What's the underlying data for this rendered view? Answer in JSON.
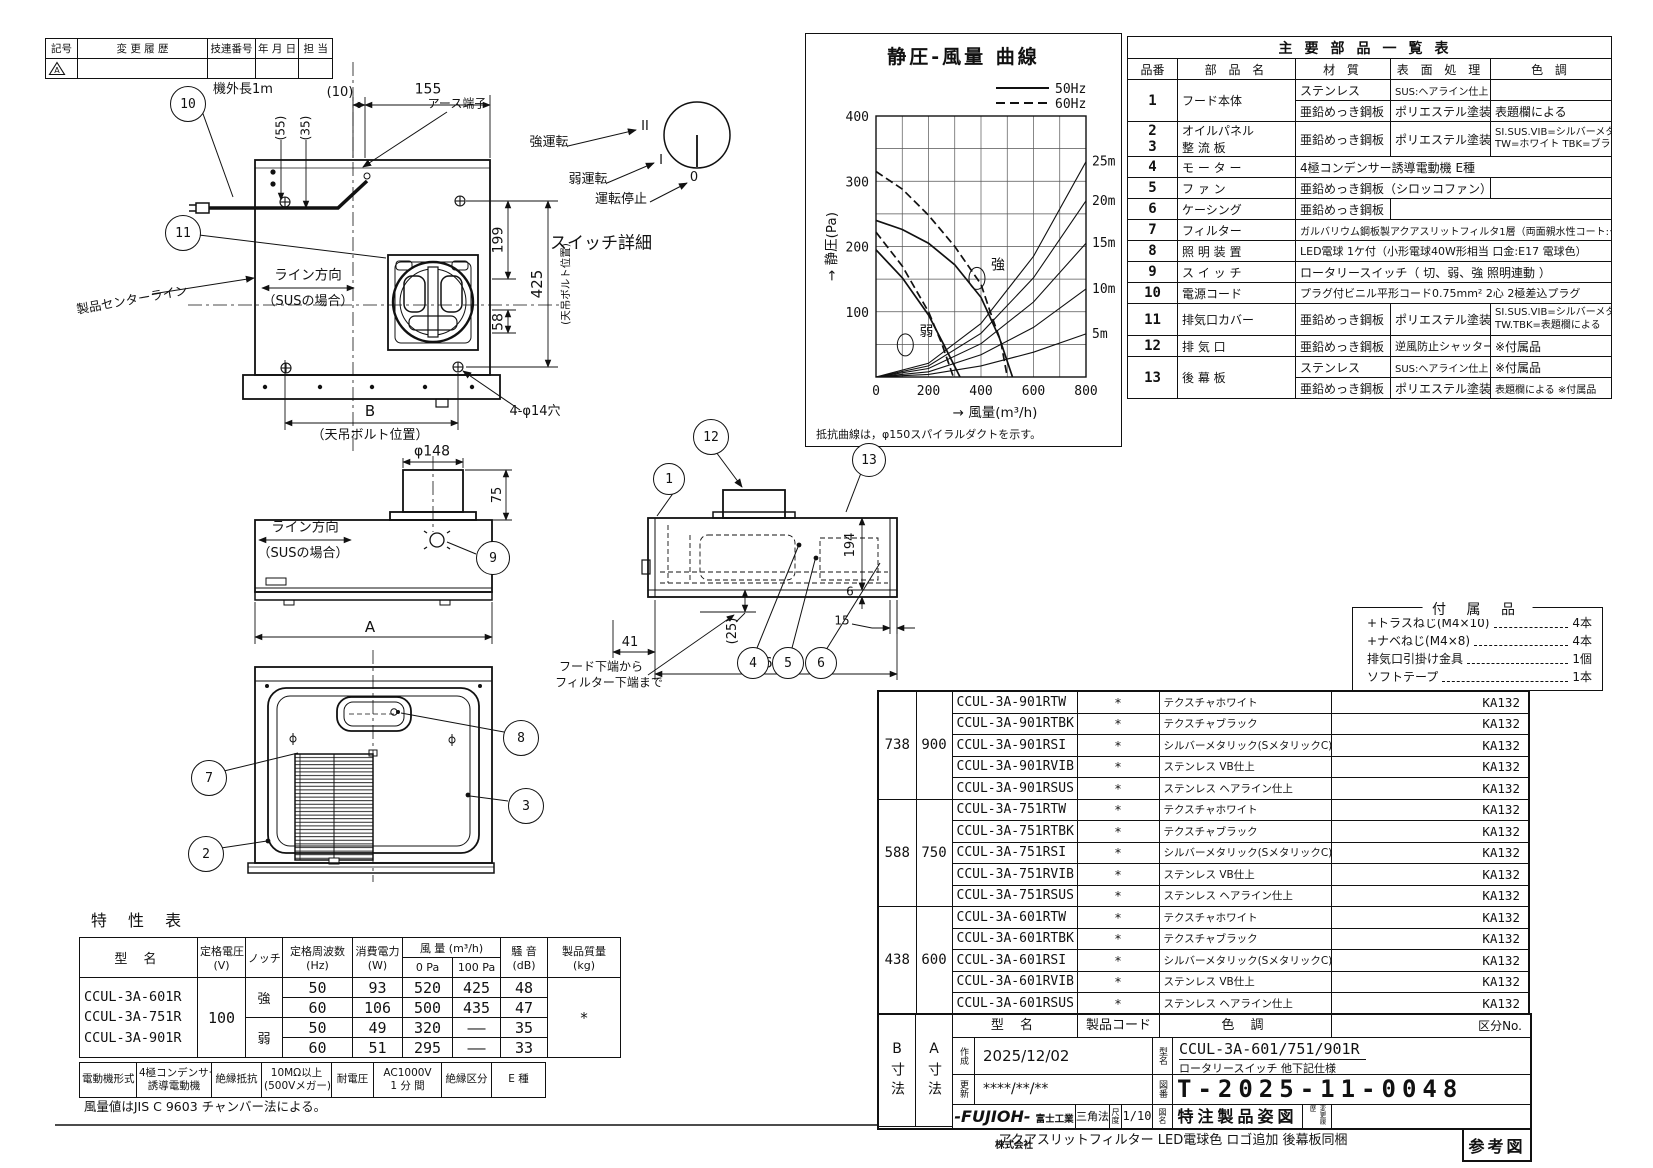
{
  "revision": {
    "h_symbol": "記号",
    "h_history": "変 更 履 歴",
    "h_number": "技連番号",
    "h_date": "年 月 日",
    "h_staff": "担 当",
    "row_symbol": "A"
  },
  "chart_data": {
    "type": "line",
    "title": "静圧-風量 曲線",
    "xlabel": "風量(m³/h)",
    "ylabel": "静圧(Pa)",
    "xlim": [
      0,
      800
    ],
    "ylim": [
      0,
      400
    ],
    "x_ticks": [
      0,
      200,
      400,
      600,
      800
    ],
    "y_ticks": [
      0,
      100,
      200,
      300,
      400
    ],
    "grid_step": {
      "x": 100,
      "y": 50
    },
    "grid": true,
    "legend_position": "top-right",
    "legend": [
      {
        "label": "50Hz",
        "style": "solid"
      },
      {
        "label": "60Hz",
        "style": "dashed"
      }
    ],
    "series": [
      {
        "name": "強 50Hz",
        "style": "solid",
        "points": [
          [
            0,
            240
          ],
          [
            100,
            226
          ],
          [
            200,
            205
          ],
          [
            300,
            172
          ],
          [
            400,
            122
          ],
          [
            425,
            100
          ],
          [
            470,
            60
          ],
          [
            520,
            0
          ]
        ]
      },
      {
        "name": "強 60Hz",
        "style": "dashed",
        "points": [
          [
            0,
            315
          ],
          [
            100,
            288
          ],
          [
            200,
            248
          ],
          [
            300,
            200
          ],
          [
            400,
            142
          ],
          [
            435,
            100
          ],
          [
            475,
            55
          ],
          [
            500,
            0
          ]
        ]
      },
      {
        "name": "弱 50Hz",
        "style": "solid",
        "points": [
          [
            0,
            195
          ],
          [
            100,
            152
          ],
          [
            200,
            95
          ],
          [
            260,
            48
          ],
          [
            320,
            0
          ]
        ]
      },
      {
        "name": "弱 60Hz",
        "style": "dashed",
        "points": [
          [
            0,
            222
          ],
          [
            100,
            170
          ],
          [
            200,
            100
          ],
          [
            250,
            52
          ],
          [
            295,
            0
          ]
        ]
      },
      {
        "name": "5m",
        "style": "solid",
        "points": [
          [
            0,
            0
          ],
          [
            200,
            4
          ],
          [
            400,
            17
          ],
          [
            600,
            38
          ],
          [
            800,
            66
          ]
        ]
      },
      {
        "name": "10m",
        "style": "solid",
        "points": [
          [
            0,
            0
          ],
          [
            200,
            8
          ],
          [
            400,
            34
          ],
          [
            600,
            76
          ],
          [
            800,
            135
          ]
        ]
      },
      {
        "name": "15m",
        "style": "solid",
        "points": [
          [
            0,
            0
          ],
          [
            200,
            13
          ],
          [
            400,
            51
          ],
          [
            600,
            115
          ],
          [
            800,
            205
          ]
        ]
      },
      {
        "name": "20m",
        "style": "solid",
        "points": [
          [
            0,
            0
          ],
          [
            200,
            17
          ],
          [
            400,
            67
          ],
          [
            600,
            152
          ],
          [
            800,
            270
          ]
        ]
      },
      {
        "name": "25m",
        "style": "solid",
        "points": [
          [
            0,
            0
          ],
          [
            200,
            21
          ],
          [
            400,
            82
          ],
          [
            600,
            185
          ],
          [
            800,
            330
          ]
        ]
      }
    ],
    "curve_labels": [
      {
        "text": "強",
        "x": 438,
        "y": 165
      },
      {
        "text": "弱",
        "x": 165,
        "y": 63
      }
    ],
    "right_labels": [
      {
        "text": "25m",
        "y": 330
      },
      {
        "text": "20m",
        "y": 270
      },
      {
        "text": "15m",
        "y": 205
      },
      {
        "text": "10m",
        "y": 135
      },
      {
        "text": "5m",
        "y": 66
      }
    ],
    "note": "抵抗曲線は，φ150スパイラルダクトを示す。"
  },
  "parts": {
    "title": "主要部品一覧表",
    "h_no": "品番",
    "h_name": "部 品 名",
    "h_mat": "材  質",
    "h_surf": "表 面 処 理",
    "h_color": "色  調",
    "r1_no": "1",
    "r1_name": "フード本体",
    "r1a_mat": "ステンレス",
    "r1a_surf": "SUS:ヘアライン仕上 VIB:VB仕上",
    "r1b_mat": "亜鉛めっき鋼板",
    "r1b_surf": "ポリエステル塗装",
    "r1b_color": "表題欄による",
    "r23_no1": "2",
    "r23_no2": "3",
    "r23_name1": "オイルパネル",
    "r23_name2": "整 流 板",
    "r23_mat": "亜鉛めっき鋼板",
    "r23_surf": "ポリエステル塗装",
    "r23_color1": "SI.SUS.VIB=シルバーメタリック",
    "r23_color2": "TW=ホワイト TBK=ブラック",
    "r4_no": "4",
    "r4_name": "モ ー タ ー",
    "r4_desc": "4極コンデンサー誘導電動機 E種",
    "r5_no": "5",
    "r5_name": "フ ァ ン",
    "r5_desc": "亜鉛めっき鋼板（シロッコファン）",
    "r6_no": "6",
    "r6_name": "ケーシング",
    "r6_mat": "亜鉛めっき鋼板",
    "r7_no": "7",
    "r7_name": "フィルター",
    "r7_desc": "ガルバリウム鋼板製アクアスリットフィルタ1層（両面親水性コート:クリアー）",
    "r8_no": "8",
    "r8_name": "照 明 装 置",
    "r8_desc": "LED電球 1ケ付（小形電球40W形相当 口金:E17 電球色）",
    "r9_no": "9",
    "r9_name": "ス イ ッ チ",
    "r9_desc": "ロータリースイッチ（ 切、弱、強   照明連動 ）",
    "r10_no": "10",
    "r10_name": "電源コード",
    "r10_desc": "プラグ付ビニル平形コード0.75mm² 2心 2極差込プラグ",
    "r11_no": "11",
    "r11_name": "排気口カバー",
    "r11_mat": "亜鉛めっき鋼板",
    "r11_surf": "ポリエステル塗装",
    "r11_color1": "SI.SUS.VIB=シルバーメタリック",
    "r11_color2": "TW.TBK=表題欄による",
    "r12_no": "12",
    "r12_name": "排 気 口",
    "r12_mat": "亜鉛めっき鋼板",
    "r12_surf": "逆風防止シャッター付",
    "r12_color": "※付属品",
    "r13_no": "13",
    "r13_name": "後 幕 板",
    "r13a_mat": "ステンレス",
    "r13a_surf": "SUS:ヘアライン仕上 VIB:VB仕上",
    "r13a_color": "※付属品",
    "r13b_mat": "亜鉛めっき鋼板",
    "r13b_surf": "ポリエステル塗装",
    "r13b_color": "表題欄による ※付属品"
  },
  "accessories": {
    "title": "付 属 品",
    "items": [
      {
        "name": "+トラスねじ(M4×10)",
        "qty": "4本"
      },
      {
        "name": "+ナベねじ(M4×8)",
        "qty": "4本"
      },
      {
        "name": "排気口引掛け金具",
        "qty": "1個"
      },
      {
        "name": "ソフトテープ",
        "qty": "1本"
      }
    ]
  },
  "models": {
    "groups": [
      {
        "b": "738",
        "a": "900",
        "rows": [
          [
            "CCUL-3A-901RTW",
            "*",
            "テクスチャホワイト",
            "KA132"
          ],
          [
            "CCUL-3A-901RTBK",
            "*",
            "テクスチャブラック",
            "KA132"
          ],
          [
            "CCUL-3A-901RSI",
            "*",
            "シルバーメタリック(SメタリックC)",
            "KA132"
          ],
          [
            "CCUL-3A-901RVIB",
            "*",
            "ステンレス VB仕上",
            "KA132"
          ],
          [
            "CCUL-3A-901RSUS",
            "*",
            "ステンレス ヘアライン仕上",
            "KA132"
          ]
        ]
      },
      {
        "b": "588",
        "a": "750",
        "rows": [
          [
            "CCUL-3A-751RTW",
            "*",
            "テクスチャホワイト",
            "KA132"
          ],
          [
            "CCUL-3A-751RTBK",
            "*",
            "テクスチャブラック",
            "KA132"
          ],
          [
            "CCUL-3A-751RSI",
            "*",
            "シルバーメタリック(SメタリックC)",
            "KA132"
          ],
          [
            "CCUL-3A-751RVIB",
            "*",
            "ステンレス VB仕上",
            "KA132"
          ],
          [
            "CCUL-3A-751RSUS",
            "*",
            "ステンレス ヘアライン仕上",
            "KA132"
          ]
        ]
      },
      {
        "b": "438",
        "a": "600",
        "rows": [
          [
            "CCUL-3A-601RTW",
            "*",
            "テクスチャホワイト",
            "KA132"
          ],
          [
            "CCUL-3A-601RTBK",
            "*",
            "テクスチャブラック",
            "KA132"
          ],
          [
            "CCUL-3A-601RSI",
            "*",
            "シルバーメタリック(SメタリックC)",
            "KA132"
          ],
          [
            "CCUL-3A-601RVIB",
            "*",
            "ステンレス VB仕上",
            "KA132"
          ],
          [
            "CCUL-3A-601RSUS",
            "*",
            "ステンレス ヘアライン仕上",
            "KA132"
          ]
        ]
      }
    ]
  },
  "title_block": {
    "b_dim": "B寸法",
    "a_dim": "A寸法",
    "f_model": "型  名",
    "f_code": "製品コード",
    "f_color": "色  調",
    "f_kubun": "区分No.",
    "created_label": "作成",
    "created": "2025/12/02",
    "updated_label": "更新",
    "updated": "****/**/**",
    "model_label": "型名",
    "model": "CCUL-3A-601/751/901R",
    "model_sub": "ロータリースイッチ 他下記仕様",
    "drawno_label": "図番",
    "drawno": "T-2025-11-0048",
    "logo": "-FUJIOH-",
    "company": "富士工業株式会社",
    "method": "三角法",
    "scale_label": "尺度",
    "scale": "1/10",
    "name_label": "図名",
    "drawing_name": "特注製品姿図",
    "rev_label": "変更履歴",
    "ref_label": "参考図"
  },
  "spec": {
    "h_model": "型  名",
    "h_volt1": "定格電圧",
    "h_volt2": "(V)",
    "h_notch": "ノッチ",
    "h_freq1": "定格周波数",
    "h_freq2": "(Hz)",
    "h_power1": "消費電力",
    "h_power2": "(W)",
    "h_flow": "風 量  (m³/h)",
    "h_0pa": "0 Pa",
    "h_100pa": "100 Pa",
    "h_noise1": "騒 音",
    "h_noise2": "(dB)",
    "h_mass1": "製品質量",
    "h_mass2": "(kg)",
    "models": [
      "CCUL-3A-601R",
      "CCUL-3A-751R",
      "CCUL-3A-901R"
    ],
    "voltage": "100",
    "mass": "*",
    "rows": [
      [
        "強",
        "50",
        "93",
        "520",
        "425",
        "48"
      ],
      [
        "",
        "60",
        "106",
        "500",
        "435",
        "47"
      ],
      [
        "弱",
        "50",
        "49",
        "320",
        "——",
        "35"
      ],
      [
        "",
        "60",
        "51",
        "295",
        "——",
        "33"
      ]
    ],
    "motor": [
      "電動機形式",
      "4極コンデンサー",
      "誘導電動機",
      "絶縁抵抗",
      "10MΩ以上",
      "(500Vメガー)",
      "耐電圧",
      "AC1000V",
      "1 分 間",
      "絶縁区分",
      "E 種"
    ]
  },
  "balloons": [
    {
      "n": "1",
      "x": 668,
      "y": 478,
      "r": 15
    },
    {
      "n": "2",
      "x": 205,
      "y": 853,
      "r": 17
    },
    {
      "n": "3",
      "x": 525,
      "y": 805,
      "r": 17
    },
    {
      "n": "4",
      "x": 752,
      "y": 662,
      "r": 15
    },
    {
      "n": "5",
      "x": 787,
      "y": 662,
      "r": 15
    },
    {
      "n": "6",
      "x": 820,
      "y": 662,
      "r": 15
    },
    {
      "n": "7",
      "x": 208,
      "y": 777,
      "r": 17
    },
    {
      "n": "8",
      "x": 520,
      "y": 737,
      "r": 17
    },
    {
      "n": "9",
      "x": 492,
      "y": 557,
      "r": 16
    },
    {
      "n": "10",
      "x": 187,
      "y": 103,
      "r": 17
    },
    {
      "n": "11",
      "x": 182,
      "y": 232,
      "r": 17
    },
    {
      "n": "12",
      "x": 710,
      "y": 436,
      "r": 17
    },
    {
      "n": "13",
      "x": 868,
      "y": 459,
      "r": 16
    }
  ],
  "labels": [
    {
      "name": "dim-outer-length",
      "text": "機外長1m",
      "x": 243,
      "y": 90,
      "size": 13
    },
    {
      "name": "dim-55",
      "text": "(55)",
      "x": 281,
      "y": 128,
      "size": 12,
      "rot": -90
    },
    {
      "name": "dim-35",
      "text": "(35)",
      "x": 306,
      "y": 128,
      "size": 12,
      "rot": -90
    },
    {
      "name": "dim-10",
      "text": "(10)",
      "x": 340,
      "y": 93,
      "size": 13
    },
    {
      "name": "dim-155",
      "text": "155",
      "x": 428,
      "y": 90,
      "size": 14
    },
    {
      "name": "earth-terminal-label",
      "text": "アース端子",
      "x": 457,
      "y": 104,
      "size": 12
    },
    {
      "name": "product-centerline-label",
      "text": "製品センターライン",
      "x": 132,
      "y": 300,
      "size": 12.5,
      "rot": -10
    },
    {
      "name": "line-direction-top",
      "text": "ライン方向",
      "x": 308,
      "y": 276,
      "size": 13.5
    },
    {
      "name": "sus-case-top",
      "text": "（SUSの場合）",
      "x": 308,
      "y": 302,
      "size": 13
    },
    {
      "name": "dim-199",
      "text": "199",
      "x": 499,
      "y": 240,
      "size": 14,
      "rot": -90
    },
    {
      "name": "dim-58",
      "text": "58",
      "x": 499,
      "y": 322,
      "size": 14,
      "rot": -90
    },
    {
      "name": "dim-425",
      "text": "425",
      "x": 537,
      "y": 284,
      "size": 15,
      "rot": -90
    },
    {
      "name": "ceiling-bolt-side",
      "text": "(天吊ボルト位置)",
      "x": 567,
      "y": 284,
      "size": 10.5,
      "rot": -90
    },
    {
      "name": "dim-B",
      "text": "B",
      "x": 370,
      "y": 411,
      "size": 15
    },
    {
      "name": "ceiling-bolt-bottom",
      "text": "（天吊ボルト位置）",
      "x": 370,
      "y": 436,
      "size": 13
    },
    {
      "name": "holes-4-phi14",
      "text": "4-φ14穴",
      "x": 535,
      "y": 412,
      "size": 13
    },
    {
      "name": "switch-strong-label",
      "text": "強運転",
      "x": 549,
      "y": 143,
      "size": 13
    },
    {
      "name": "switch-weak-label",
      "text": "弱運転",
      "x": 588,
      "y": 180,
      "size": 13
    },
    {
      "name": "switch-stop-label",
      "text": "運転停止",
      "x": 621,
      "y": 200,
      "size": 13
    },
    {
      "name": "switch-mark-strong",
      "text": "II",
      "x": 645,
      "y": 127,
      "size": 13
    },
    {
      "name": "switch-mark-weak",
      "text": "I",
      "x": 661,
      "y": 161,
      "size": 13
    },
    {
      "name": "switch-mark-stop",
      "text": "0",
      "x": 694,
      "y": 178,
      "size": 13
    },
    {
      "name": "switch-detail-title",
      "text": "スイッチ詳細",
      "x": 601,
      "y": 244,
      "size": 17
    },
    {
      "name": "dim-phi148",
      "text": "φ148",
      "x": 432,
      "y": 452,
      "size": 14
    },
    {
      "name": "dim-75",
      "text": "75",
      "x": 498,
      "y": 495,
      "size": 13,
      "rot": -90
    },
    {
      "name": "line-direction-front",
      "text": "ライン方向",
      "x": 305,
      "y": 528,
      "size": 13.5
    },
    {
      "name": "sus-case-front",
      "text": "（SUSの場合）",
      "x": 303,
      "y": 554,
      "size": 13
    },
    {
      "name": "dim-A",
      "text": "A",
      "x": 370,
      "y": 627,
      "size": 15
    },
    {
      "name": "dim-41",
      "text": "41",
      "x": 630,
      "y": 643,
      "size": 13
    },
    {
      "name": "dim-25",
      "text": "(25)",
      "x": 733,
      "y": 631,
      "size": 13,
      "rot": -90
    },
    {
      "name": "dim-615",
      "text": "615",
      "x": 777,
      "y": 664,
      "size": 14
    },
    {
      "name": "dim-194",
      "text": "194",
      "x": 851,
      "y": 545,
      "size": 13,
      "rot": -90
    },
    {
      "name": "dim-6",
      "text": "6",
      "x": 850,
      "y": 592,
      "size": 12
    },
    {
      "name": "dim-15",
      "text": "15",
      "x": 842,
      "y": 621,
      "size": 12
    },
    {
      "name": "hood-note-line1",
      "text": "フード下端から",
      "x": 601,
      "y": 667,
      "size": 12
    },
    {
      "name": "hood-note-line2",
      "text": "フィルター下端まで",
      "x": 609,
      "y": 683,
      "size": 12
    },
    {
      "name": "spec-table-title",
      "text": "特 性 表",
      "x": 140,
      "y": 921,
      "size": 16,
      "ls": 8
    },
    {
      "name": "spec-note",
      "text": "風量値はJIS C 9603 チャンバー法による。",
      "x": 205,
      "y": 1107,
      "size": 12.5
    },
    {
      "name": "bottom-note",
      "text": "アクアスリットフィルター LED電球色 ロゴ追加 後幕板同梱",
      "x": 1173,
      "y": 1141,
      "size": 13
    }
  ]
}
